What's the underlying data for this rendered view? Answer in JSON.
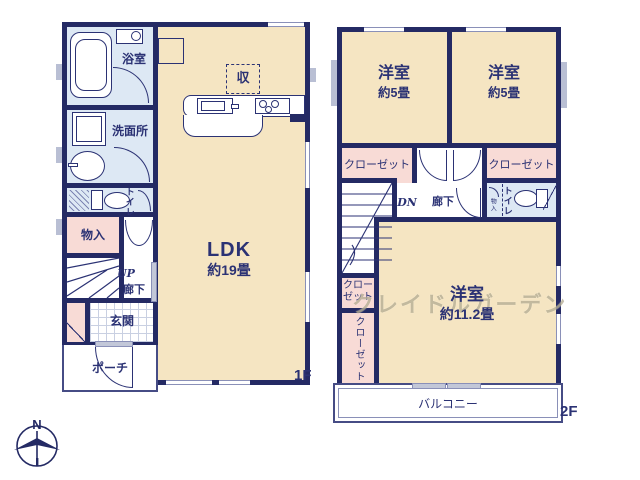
{
  "floor1": {
    "floor_label": "1F",
    "bath": "浴室",
    "washroom": "洗面所",
    "toilet": "トイレ",
    "storage": "物入",
    "stairs_up": "UP",
    "hallway": "廊下",
    "entrance": "玄関",
    "porch": "ポーチ",
    "ldk_name": "LDK",
    "ldk_size": "約19畳",
    "kitchen_storage": "収"
  },
  "floor2": {
    "floor_label": "2F",
    "bedroom1_name": "洋室",
    "bedroom1_size": "約5畳",
    "bedroom2_name": "洋室",
    "bedroom2_size": "約5畳",
    "bedroom3_name": "洋室",
    "bedroom3_size": "約11.2畳",
    "closet_left": "クローゼット",
    "closet_right": "クローゼット",
    "closet_small_line1": "クロー",
    "closet_small_line2": "ゼット",
    "closet_tall": "クローゼット",
    "stairs_down": "DN",
    "hallway": "廊下",
    "toilet": "トイレ",
    "toilet_storage": "物入",
    "balcony": "バルコニー"
  },
  "watermark": "クレイドルガーデン",
  "compass_north": "N",
  "colors": {
    "wall_navy": "#242a64",
    "room_cream": "#f5e5c2",
    "wet_area_blue": "#dde8f4",
    "closet_pink": "#f8dbd6",
    "window_gray": "#b9bfd4"
  }
}
